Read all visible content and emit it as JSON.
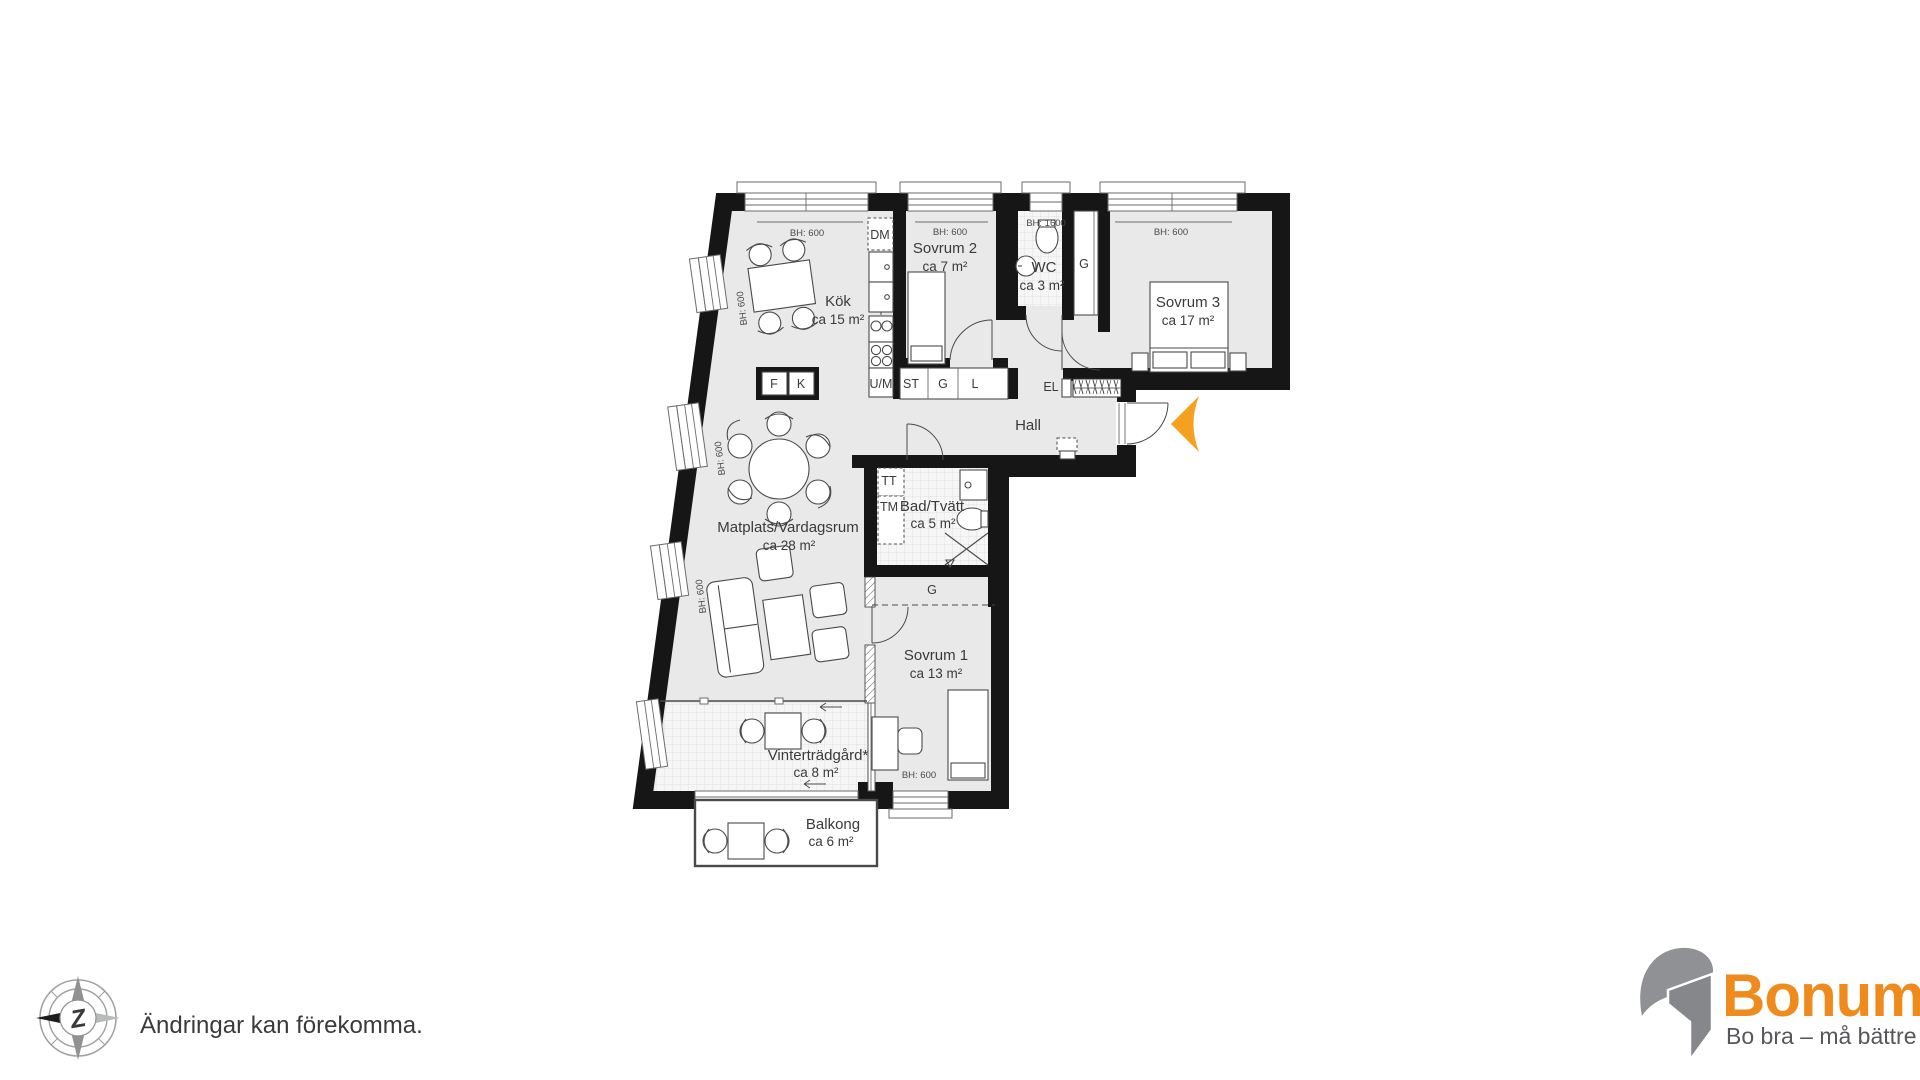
{
  "plan_title": "3 rok floor plan",
  "rooms": [
    {
      "id": "kok",
      "name": "Kök",
      "area": "ca 15 m²"
    },
    {
      "id": "sovrum2",
      "name": "Sovrum 2",
      "area": "ca 7 m²"
    },
    {
      "id": "wc",
      "name": "WC",
      "area": "ca 3 m²"
    },
    {
      "id": "sovrum3",
      "name": "Sovrum 3",
      "area": "ca 17 m²"
    },
    {
      "id": "hall",
      "name": "Hall",
      "area": ""
    },
    {
      "id": "bad_tvatt",
      "name": "Bad/Tvätt",
      "area": "ca 5 m²"
    },
    {
      "id": "matplats_vardagsrum",
      "name": "Matplats/Vardagsrum",
      "area": "ca 28 m²"
    },
    {
      "id": "sovrum1",
      "name": "Sovrum 1",
      "area": "ca 13 m²"
    },
    {
      "id": "vintertradgard",
      "name": "Vinterträdgård*",
      "area": "ca 8 m²"
    },
    {
      "id": "balkong",
      "name": "Balkong",
      "area": "ca 6 m²"
    }
  ],
  "fixtures": {
    "dm": "DM",
    "um": "U/M",
    "st": "ST",
    "garderob": "G",
    "linne": "L",
    "el": "EL",
    "frys": "F",
    "kyl": "K",
    "tt": "TT",
    "tm": "TM",
    "garderob_wc": "G",
    "garderob_sovrum1": "G"
  },
  "window_labels": {
    "bh600": "BH: 600",
    "bh1600": "BH: 1600"
  },
  "footer": {
    "disclaimer": "Ändringar kan förekomma.",
    "compass_letter": "Z"
  },
  "branding": {
    "name": "Bonum",
    "tagline": "Bo bra – må bättre"
  },
  "colors": {
    "wall": "#161616",
    "floor": "#e9e9e9",
    "tile": "#f6f6f6",
    "entry_arrow": "#f5a01e",
    "brand_orange": "#ef8a1d",
    "logo_gray": "#8c8e92",
    "tagline_gray": "#55575b"
  }
}
